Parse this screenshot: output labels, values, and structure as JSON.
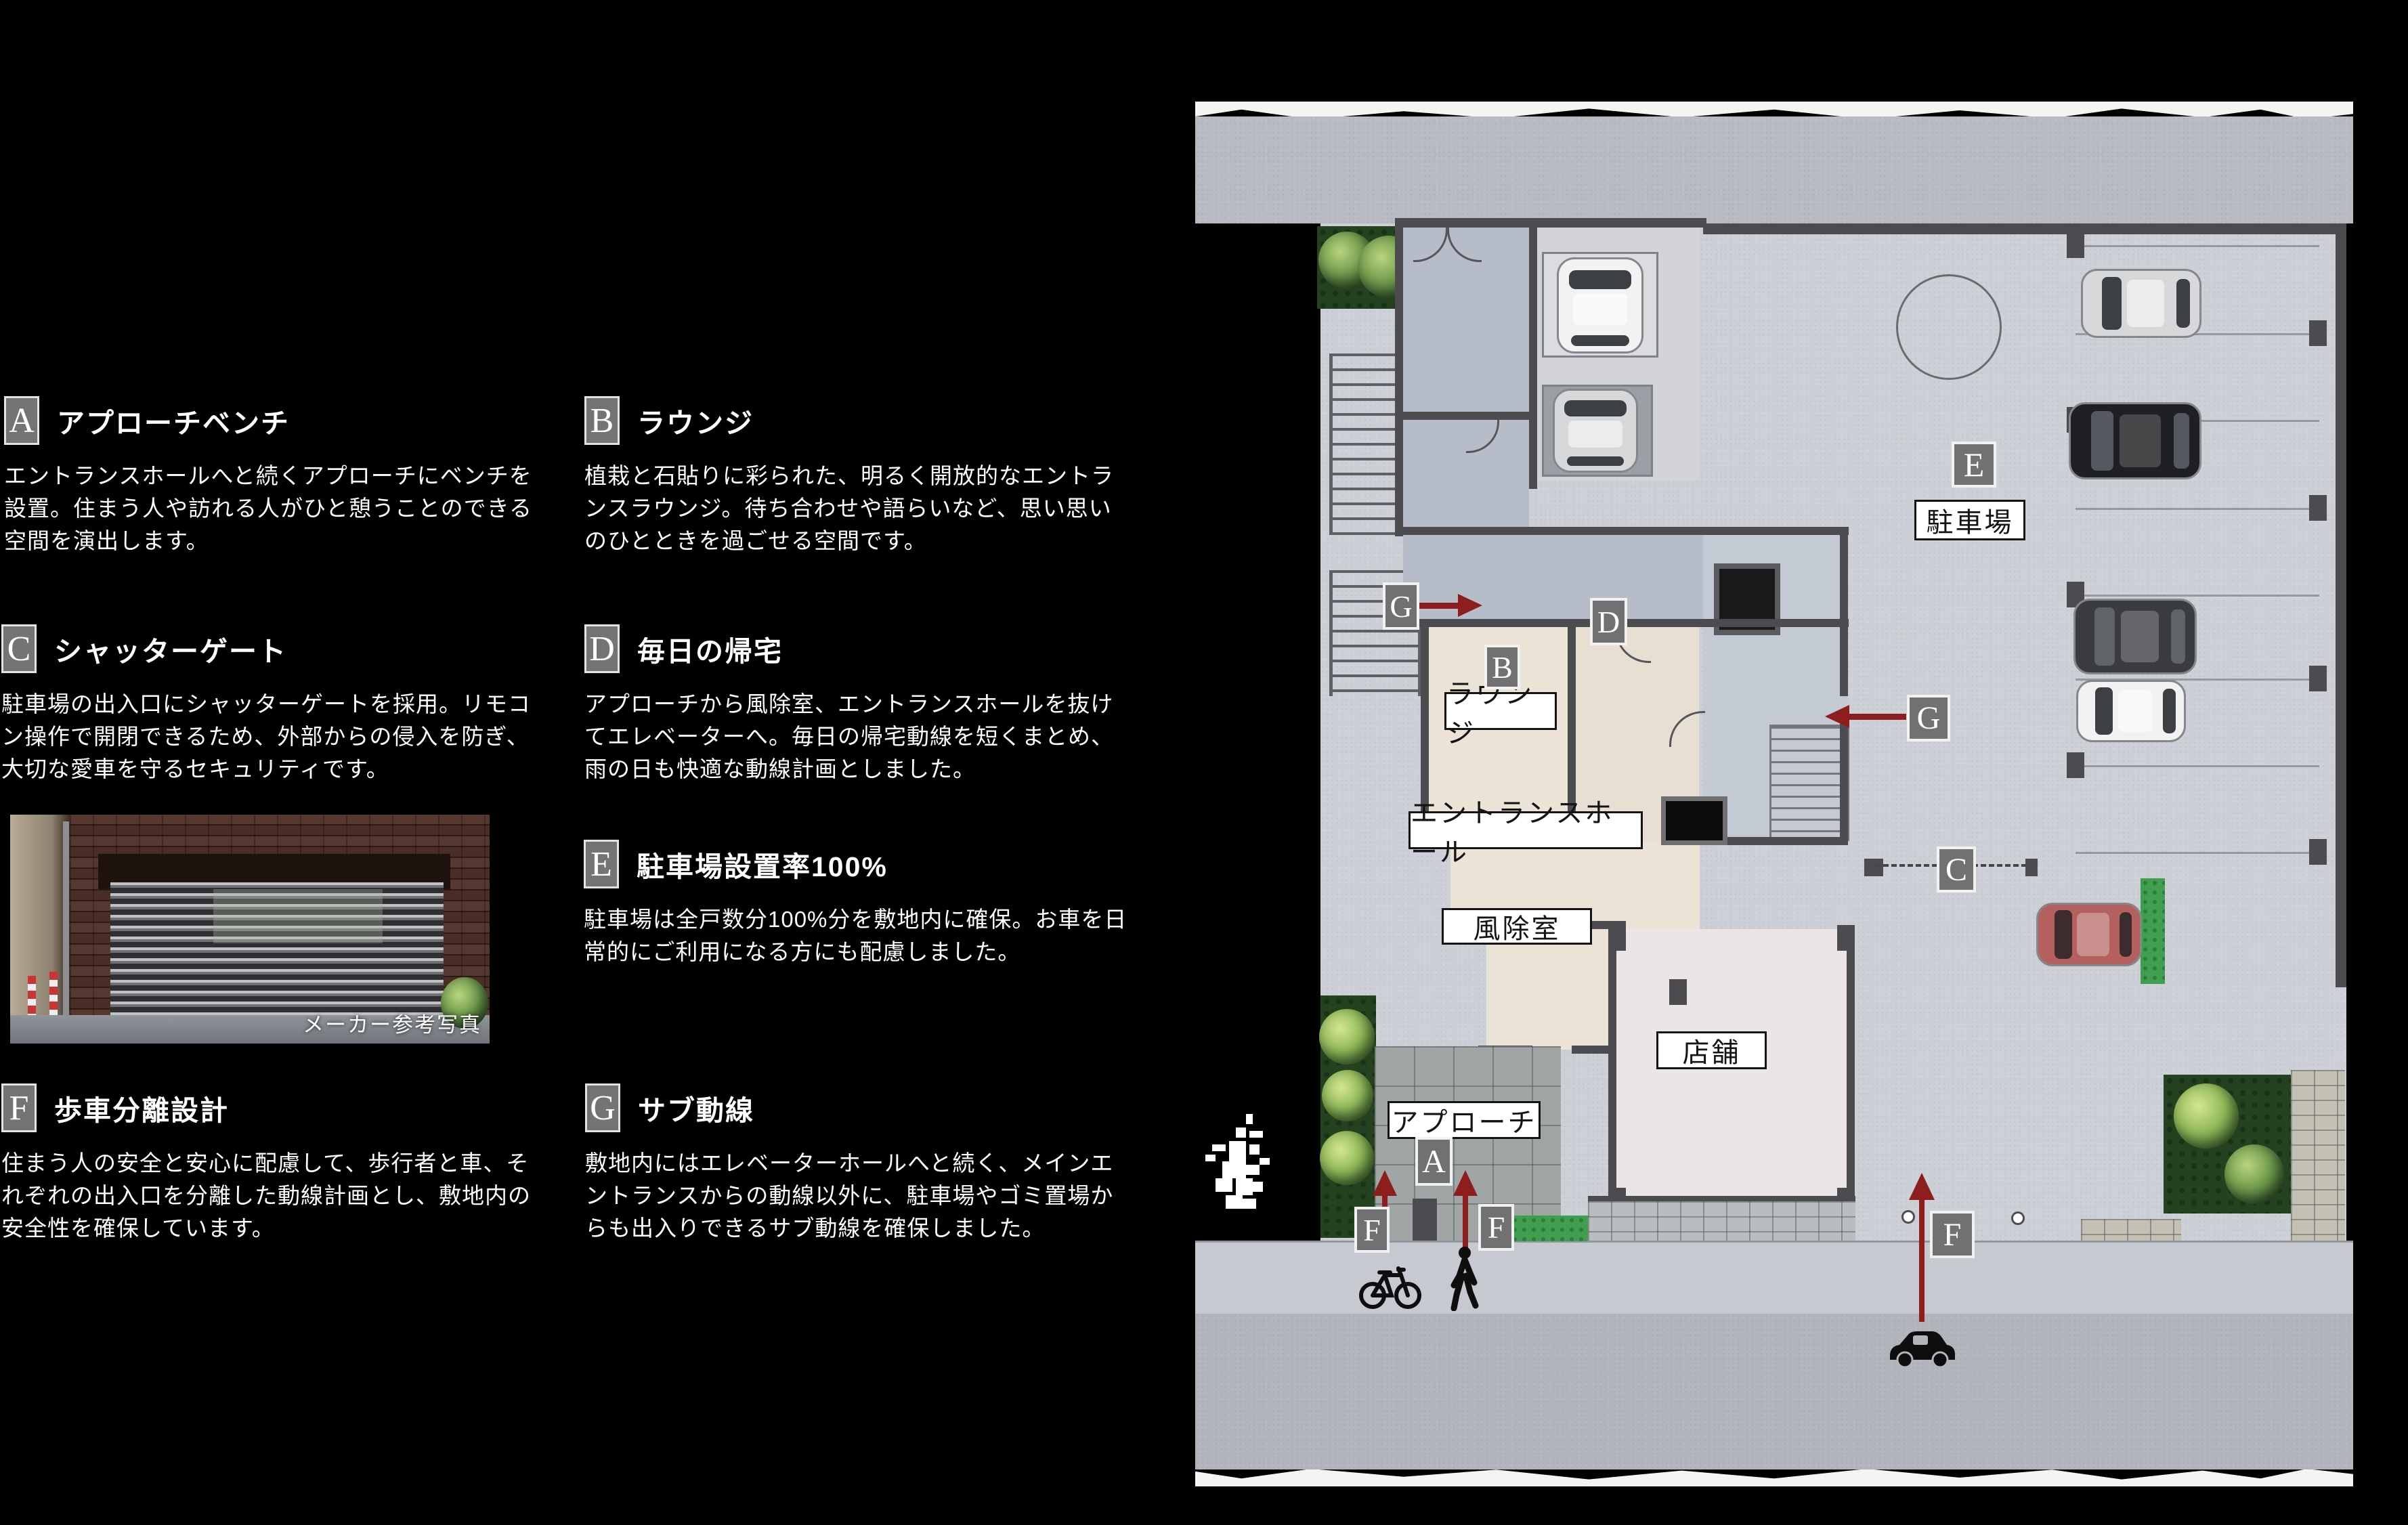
{
  "legend": {
    "sections": [
      {
        "letter": "A",
        "title": "アプローチベンチ",
        "description": "エントランスホールへと続くアプローチにベンチを設置。住まう人や訪れる人がひと憩うことのできる空間を演出します。"
      },
      {
        "letter": "B",
        "title": "ラウンジ",
        "description": "植栽と石貼りに彩られた、明るく開放的なエントランスラウンジ。待ち合わせや語らいなど、思い思いのひとときを過ごせる空間です。"
      },
      {
        "letter": "C",
        "title": "シャッターゲート",
        "description": "駐車場の出入口にシャッターゲートを採用。リモコン操作で開閉できるため、外部からの侵入を防ぎ、大切な愛車を守るセキュリティです。"
      },
      {
        "letter": "D",
        "title": "毎日の帰宅",
        "description": "アプローチから風除室、エントランスホールを抜けてエレベーターへ。毎日の帰宅動線を短くまとめ、雨の日も快適な動線計画としました。"
      },
      {
        "letter": "E",
        "title": "駐車場設置率100%",
        "description": "駐車場は全戸数分100%分を敷地内に確保。お車を日常的にご利用になる方にも配慮しました。"
      },
      {
        "letter": "F",
        "title": "歩車分離設計",
        "description": "住まう人の安全と安心に配慮して、歩行者と車、それぞれの出入口を分離した動線計画とし、敷地内の安全性を確保しています。"
      },
      {
        "letter": "G",
        "title": "サブ動線",
        "description": "敷地内にはエレベーターホールへと続く、メインエントランスからの動線以外に、駐車場やゴミ置場からも出入りできるサブ動線を確保しました。"
      }
    ],
    "photo_caption": "メーカー参考写真"
  },
  "map": {
    "markers": {
      "a": "A",
      "b": "B",
      "c": "C",
      "d": "D",
      "e": "E",
      "f": "F",
      "g": "G"
    },
    "area_labels": {
      "parking": "駐車場",
      "lounge": "ラウンジ",
      "entrance_hall": "エントランスホール",
      "windbreak_room": "風除室",
      "shop": "店舗",
      "approach": "アプローチ"
    },
    "icons": [
      "bicycle-icon",
      "pedestrian-icon",
      "car-icon",
      "north-mark"
    ],
    "arrow_color": "#8e1d1d",
    "label_text_color": "#141414",
    "marker_bg_color": "#717174"
  }
}
